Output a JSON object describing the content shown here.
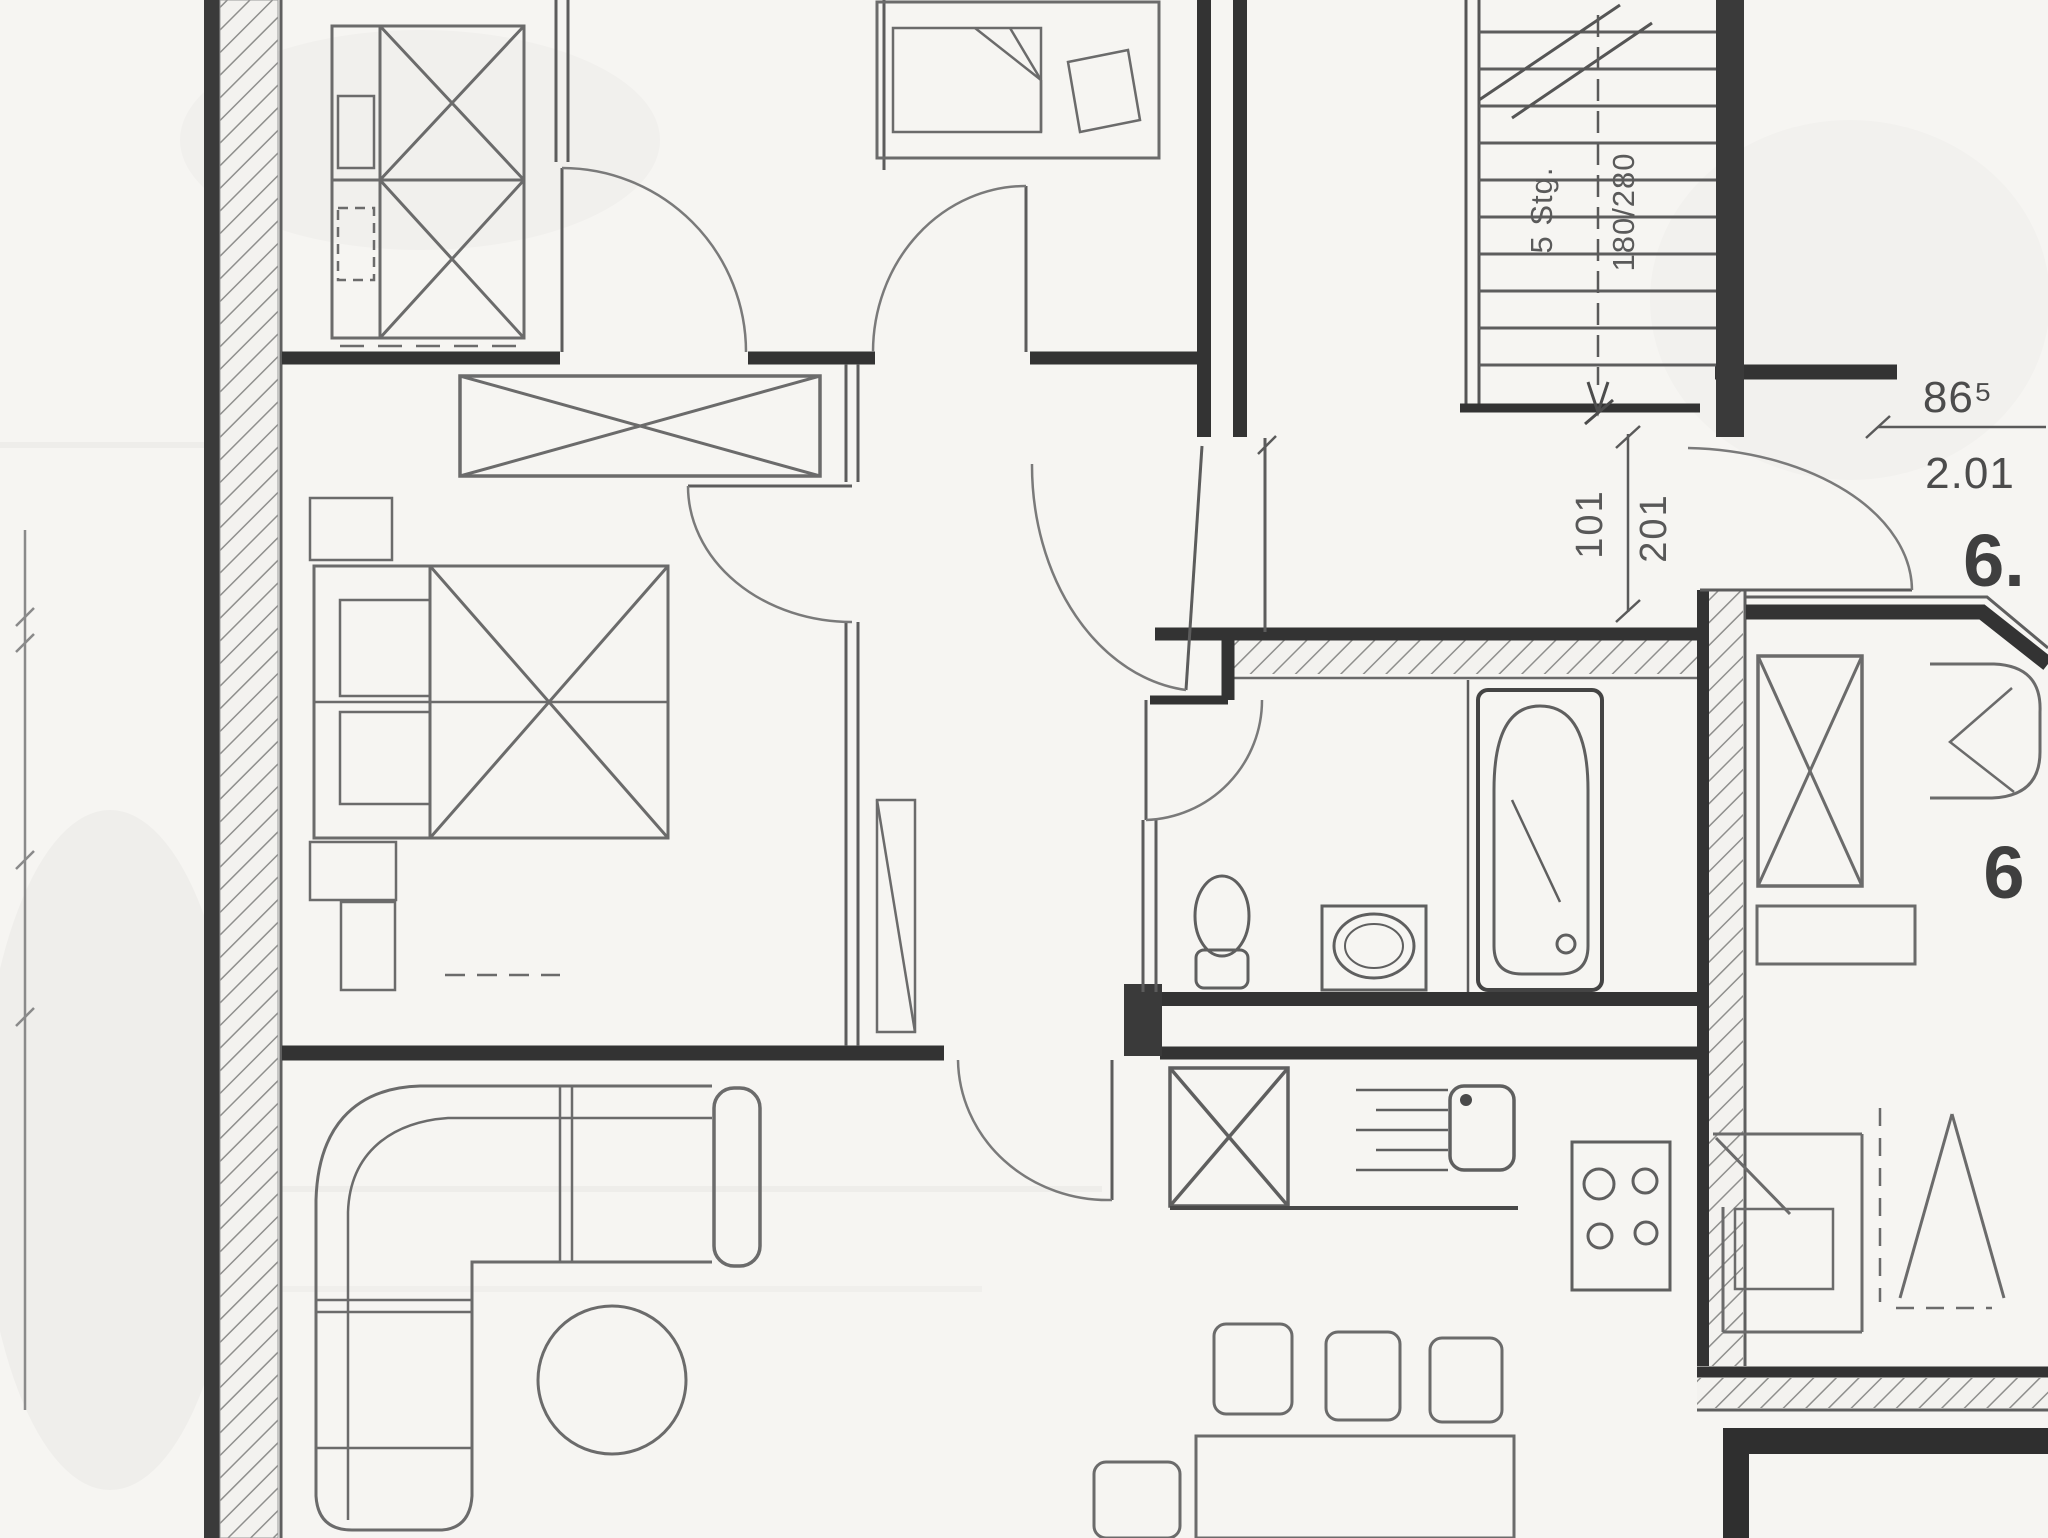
{
  "labels": {
    "stairs": {
      "flight": "5 Stg.",
      "rise_run": "180/280"
    },
    "dimensions": {
      "opening_inner": "101",
      "opening_outer": "201",
      "door_width": "86⁵",
      "door_clear": "2.01"
    },
    "units": {
      "apartment": "6.",
      "room": "6"
    }
  },
  "colors": {
    "paper": "#f6f5f2",
    "wall_ink": "#333333",
    "line_ink": "#6b6b6b",
    "faint_ink": "#9a9a9a"
  }
}
